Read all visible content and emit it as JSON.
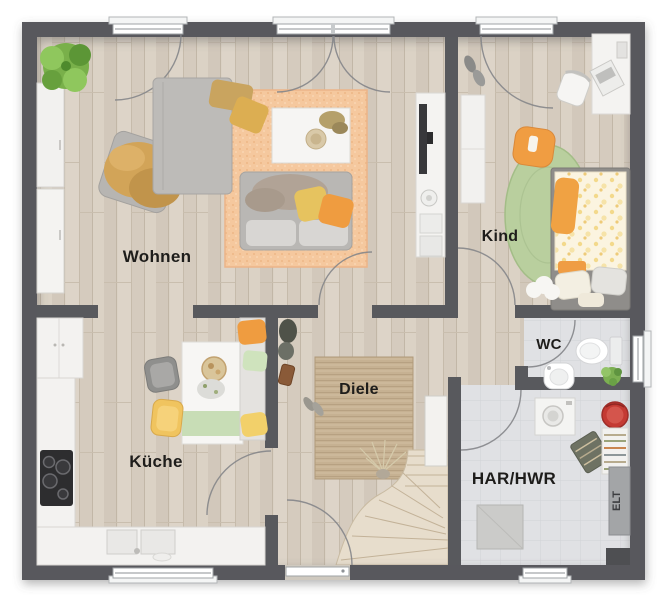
{
  "plan": {
    "type": "residential-floor-plan-top-view",
    "floor_labels": {
      "wohnen": "Wohnen",
      "kind": "Kind",
      "kueche": "Küche",
      "diele": "Diele",
      "wc": "WC",
      "har_hwr": "HAR/HWR",
      "elt": "ELT"
    },
    "colors": {
      "wall": "#58595d",
      "wood_floor": "#d8cfc3",
      "tile_floor": "#e0e1e4",
      "living_rug": "#f5c89e",
      "hall_rug": "#c6b192",
      "kid_rug_green": "#b9cf9e",
      "accent_orange": "#ef9c40",
      "accent_yellow": "#e6c35f",
      "basket_red": "#c43a33"
    }
  }
}
